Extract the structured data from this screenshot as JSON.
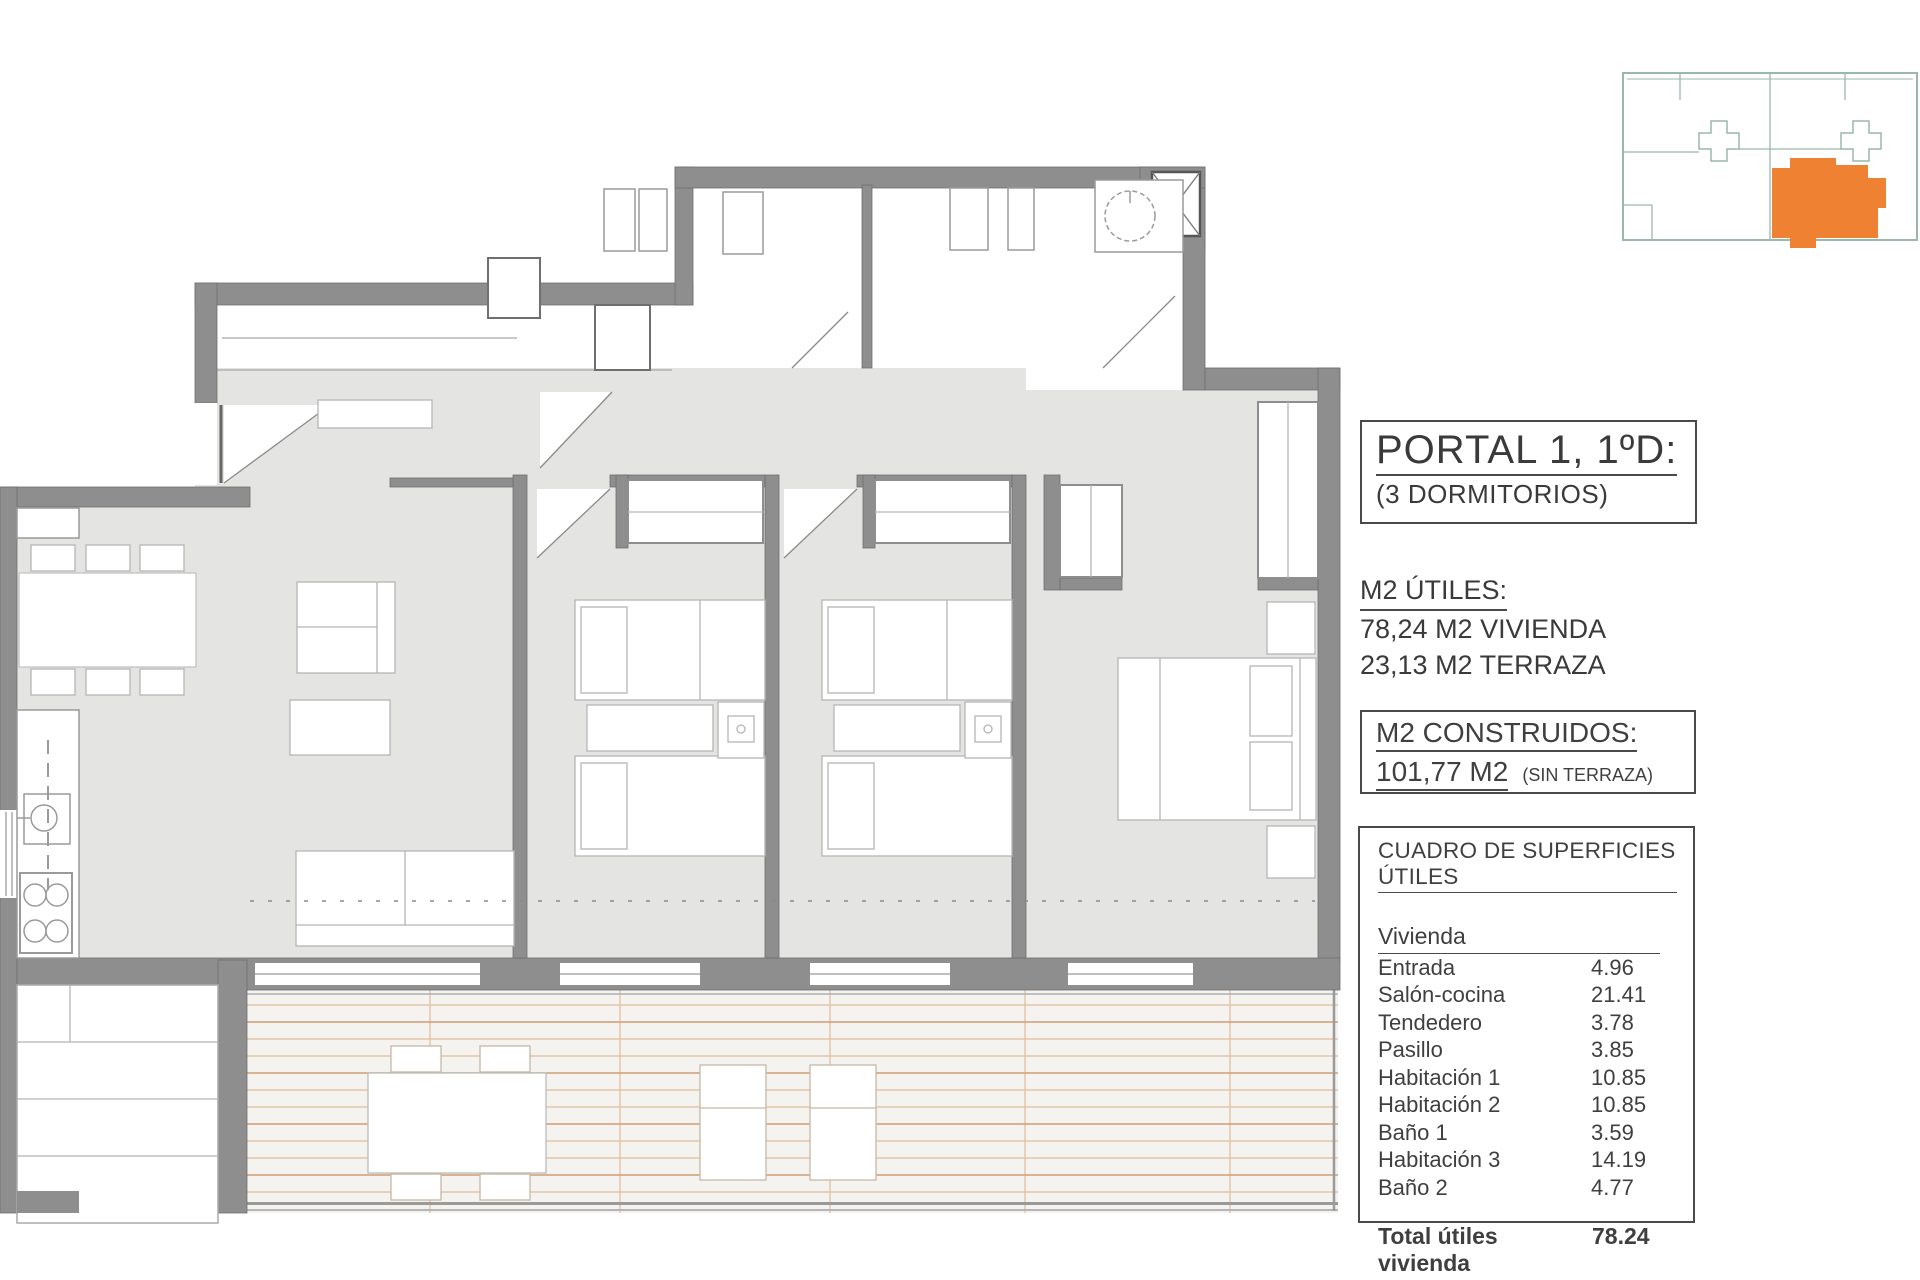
{
  "colors": {
    "wall": "#8e8e8e",
    "floor": "#e4e4e3",
    "terrace_bg": "#f5f3f0",
    "terrace_line": "#e0bd99",
    "accent_orange": "#ef8133",
    "keymap_line": "#9bb7ab"
  },
  "panel": {
    "title": "PORTAL 1, 1ºD:",
    "subtitle": "(3 DORMITORIOS)",
    "utiles_heading": "M2 ÚTILES:",
    "utiles_line1": "78,24 M2 VIVIENDA",
    "utiles_line2": "23,13 M2 TERRAZA",
    "construidos_heading": "M2 CONSTRUIDOS:",
    "construidos_value": "101,77 M2",
    "construidos_note": "(SIN TERRAZA)",
    "table": {
      "heading": "CUADRO DE SUPERFICIES ÚTILES",
      "group": "Vivienda",
      "rows": [
        {
          "label": "Entrada",
          "value": "4.96"
        },
        {
          "label": "Salón-cocina",
          "value": "21.41"
        },
        {
          "label": "Tendedero",
          "value": "3.78"
        },
        {
          "label": "Pasillo",
          "value": "3.85"
        },
        {
          "label": "Habitación 1",
          "value": "10.85"
        },
        {
          "label": "Habitación 2",
          "value": "10.85"
        },
        {
          "label": "Baño 1",
          "value": "3.59"
        },
        {
          "label": "Habitación 3",
          "value": "14.19"
        },
        {
          "label": "Baño 2",
          "value": "4.77"
        }
      ],
      "total_label": "Total útiles vivienda",
      "total_value": "78.24"
    }
  }
}
